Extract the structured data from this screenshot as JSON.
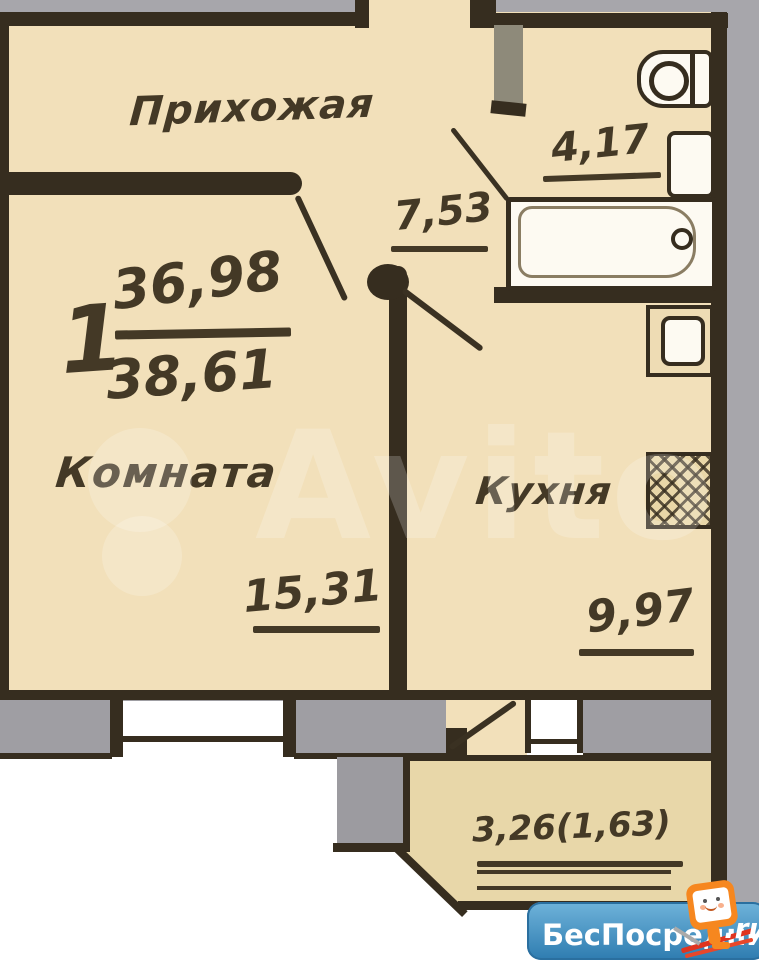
{
  "plan": {
    "summary": {
      "rooms_count": "1",
      "living_area": "36,98",
      "total_area": "38,61"
    },
    "rooms": {
      "hallway": {
        "label": "Прихожая",
        "area": "7,53"
      },
      "living_room": {
        "label": "Комната",
        "area": "15,31"
      },
      "kitchen": {
        "label": "Кухня",
        "area": "9,97"
      },
      "bathroom": {
        "area": "4,17"
      },
      "balcony": {
        "area": "3,26(1,63)"
      }
    }
  },
  "watermark": {
    "text": "Avito"
  },
  "brand": {
    "name": "БесПосредника",
    "tld": ".ru"
  },
  "colors": {
    "floor": "#f2e0ba",
    "balcony_floor": "#e8d7a9",
    "wall_dark": "#362d1f",
    "wall_gray": "#9c9ba0",
    "exterior_gray": "#a7a6ab",
    "logo_blue": "#3f8cbe",
    "mascot_orange": "#f6871f"
  }
}
